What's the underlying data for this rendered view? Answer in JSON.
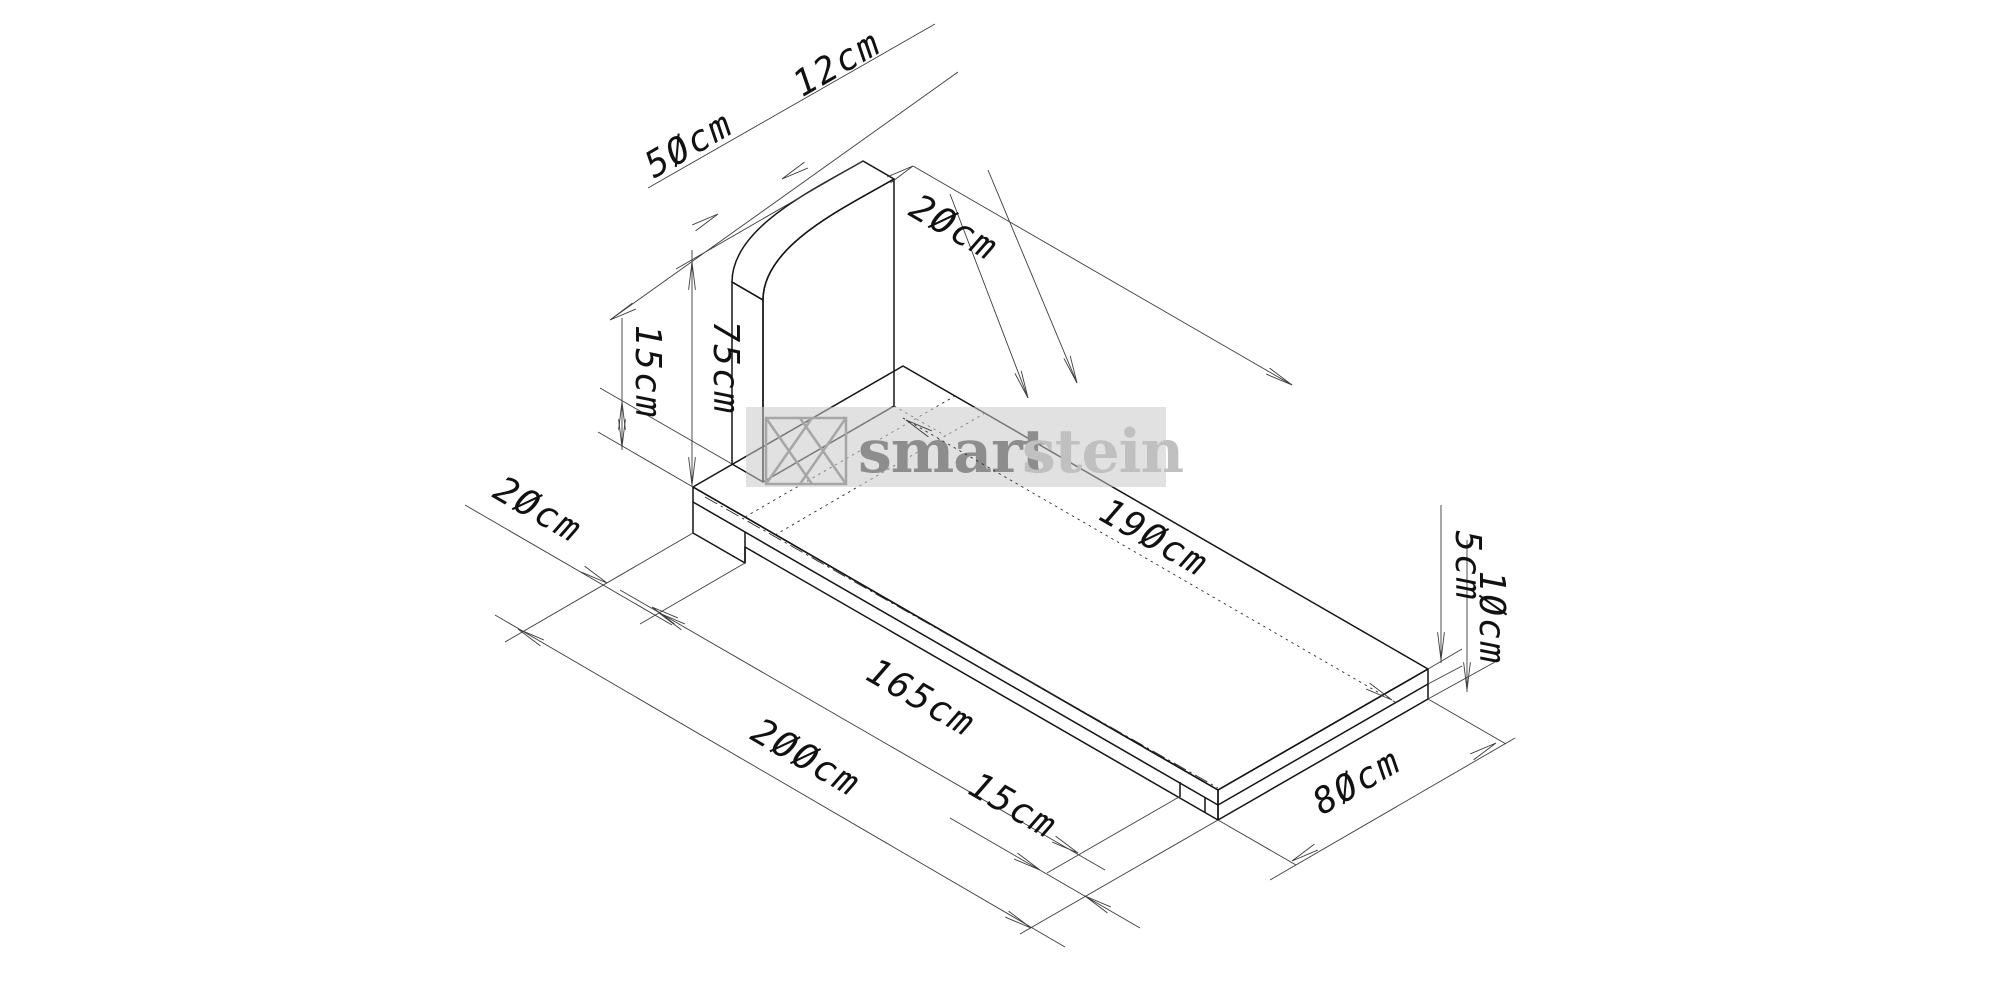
{
  "watermark": {
    "brand": "smartstein",
    "brand_prefix": "smart",
    "brand_suffix": "stein",
    "prefix_color": "#8d8d8d",
    "suffix_color": "#c0c0c0",
    "band_color": "#c8c8c8",
    "logo_color": "#a6a6a6"
  },
  "drawing": {
    "type": "isometric-technical-drawing",
    "subject": "grave monument: rounded-top headstone on base slab",
    "unit": "cm",
    "colors": {
      "slab_top": "#a9a9a9",
      "slab_front": "#9c9c9c",
      "slab_end": "#8f8f8f",
      "stone_front": "#a4a4a4",
      "stone_side": "#8f8f8f",
      "stone_top_band_light": "#dadada",
      "stone_top_band_dark": "#a2a2a2",
      "outline": "#141414",
      "dimension_lines": "#3c3c3c"
    },
    "dimensions": {
      "stone_width": {
        "label": "50cm",
        "value": 50,
        "meaning": "headstone width"
      },
      "stone_thickness": {
        "label": "12cm",
        "value": 12,
        "meaning": "headstone thickness"
      },
      "stone_height": {
        "label": "75cm",
        "value": 75,
        "meaning": "headstone height"
      },
      "stone_side_offset": {
        "label": "15cm",
        "value": 15,
        "meaning": "side offset of stone on slab"
      },
      "stone_front_clearance": {
        "label": "20cm",
        "value": 20,
        "meaning": "clearance in front of stone"
      },
      "head_section_length": {
        "label": "20cm",
        "value": 20,
        "meaning": "head section length"
      },
      "slab_inner_length": {
        "label": "190cm",
        "value": 190,
        "meaning": "inner slab length"
      },
      "slab_middle_length": {
        "label": "165cm",
        "value": 165,
        "meaning": "middle section length"
      },
      "slab_total_length": {
        "label": "200cm",
        "value": 200,
        "meaning": "total slab length"
      },
      "foot_section_length": {
        "label": "15cm",
        "value": 15,
        "meaning": "foot section length"
      },
      "slab_width": {
        "label": "80cm",
        "value": 80,
        "meaning": "slab width"
      },
      "slab_top_height": {
        "label": "5cm",
        "value": 5,
        "meaning": "top tier height"
      },
      "slab_total_height": {
        "label": "10cm",
        "value": 10,
        "meaning": "total slab height"
      }
    }
  }
}
